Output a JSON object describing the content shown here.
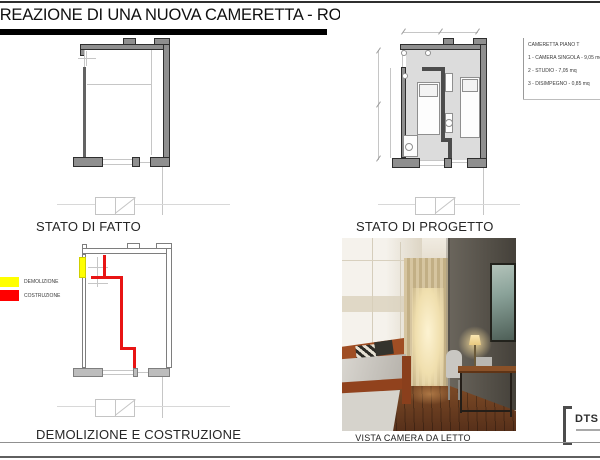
{
  "sheet": {
    "title": "CREAZIONE DI UNA NUOVA CAMERETTA - ROMA"
  },
  "room_schedule": {
    "title": "CAMERETTA PIANO T",
    "items": [
      "1 - CAMERA SINGOLA - 9,05 mq",
      "2 - STUDIO - 7,05 mq",
      "3 - DISIMPEGNO - 0,85 mq"
    ]
  },
  "panels": {
    "fatto_label": "STATO DI FATTO",
    "progetto_label": "STATO DI PROGETTO",
    "demolizione_label": "DEMOLIZIONE E COSTRUZIONE",
    "render_caption": "VISTA CAMERA DA LETTO"
  },
  "demolition_legend": {
    "items": [
      {
        "label": "DEMOLIZIONE",
        "color": "#ffff00"
      },
      {
        "label": "COSTRUZIONE",
        "color": "#ff0000"
      }
    ]
  },
  "logo": {
    "text": "DTS"
  },
  "colors": {
    "wall_fill": "#8f8f8f",
    "floor_fill": "#dcdcdc",
    "construction_red": "#e81414",
    "demolition_yellow": "#ffff00",
    "title_bar": "#000000"
  }
}
